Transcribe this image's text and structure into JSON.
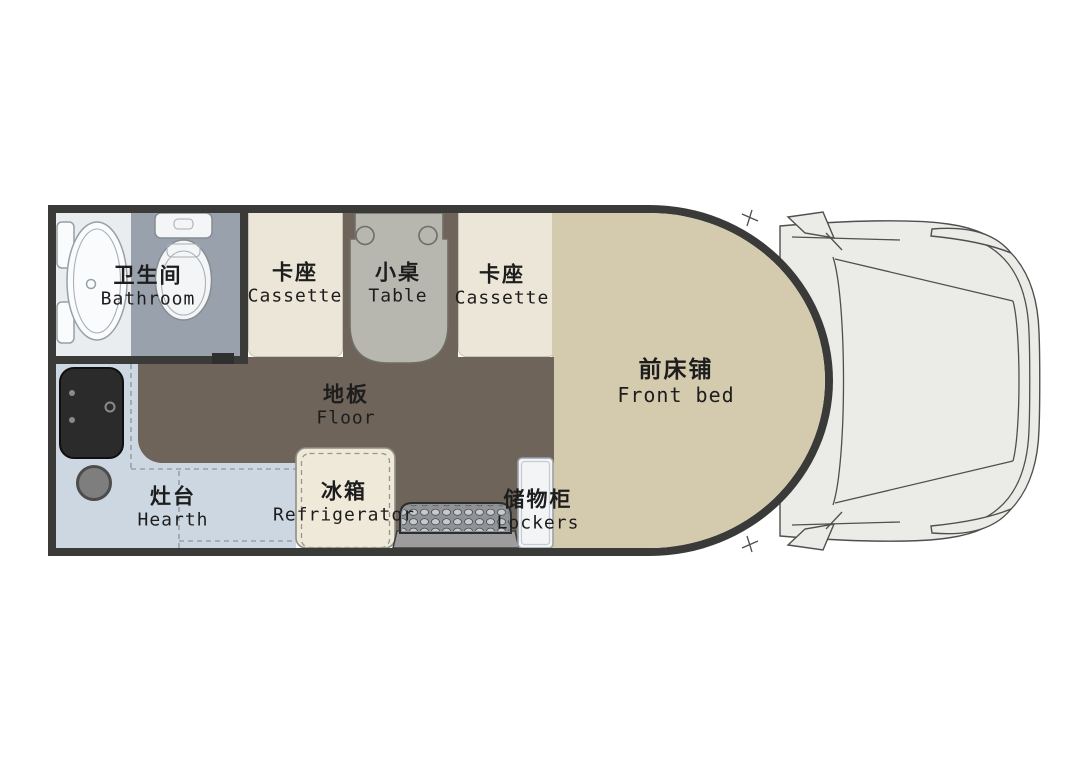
{
  "labels": {
    "bathroom": {
      "zh": "卫生间",
      "en": "Bathroom"
    },
    "cassette_left": {
      "zh": "卡座",
      "en": "Cassette"
    },
    "table": {
      "zh": "小桌",
      "en": "Table"
    },
    "cassette_right": {
      "zh": "卡座",
      "en": "Cassette"
    },
    "front_bed": {
      "zh": "前床铺",
      "en": "Front bed"
    },
    "floor": {
      "zh": "地板",
      "en": "Floor"
    },
    "hearth": {
      "zh": "灶台",
      "en": "Hearth"
    },
    "refrigerator": {
      "zh": "冰箱",
      "en": "Refrigerator"
    },
    "lockers": {
      "zh": "储物柜",
      "en": "Lockers"
    }
  },
  "colors": {
    "wall": "#3a3a38",
    "floor": "#6e6459",
    "bed": "#d4cbae",
    "cassette": "#ebe6d8",
    "table": "#b7b7af",
    "bathroom": "#e9edf0",
    "toilet_area": "#99a2ac",
    "counter": "#cdd7e1",
    "stove": "#2b2b2c",
    "fridge": "#efe9da",
    "locker": "#f2f4f6",
    "step_base": "#9d9d9d",
    "step_mat": "#8f9397",
    "cab": "#ebece7",
    "line": "#4f4f4f",
    "text": "#1d1d1d"
  }
}
